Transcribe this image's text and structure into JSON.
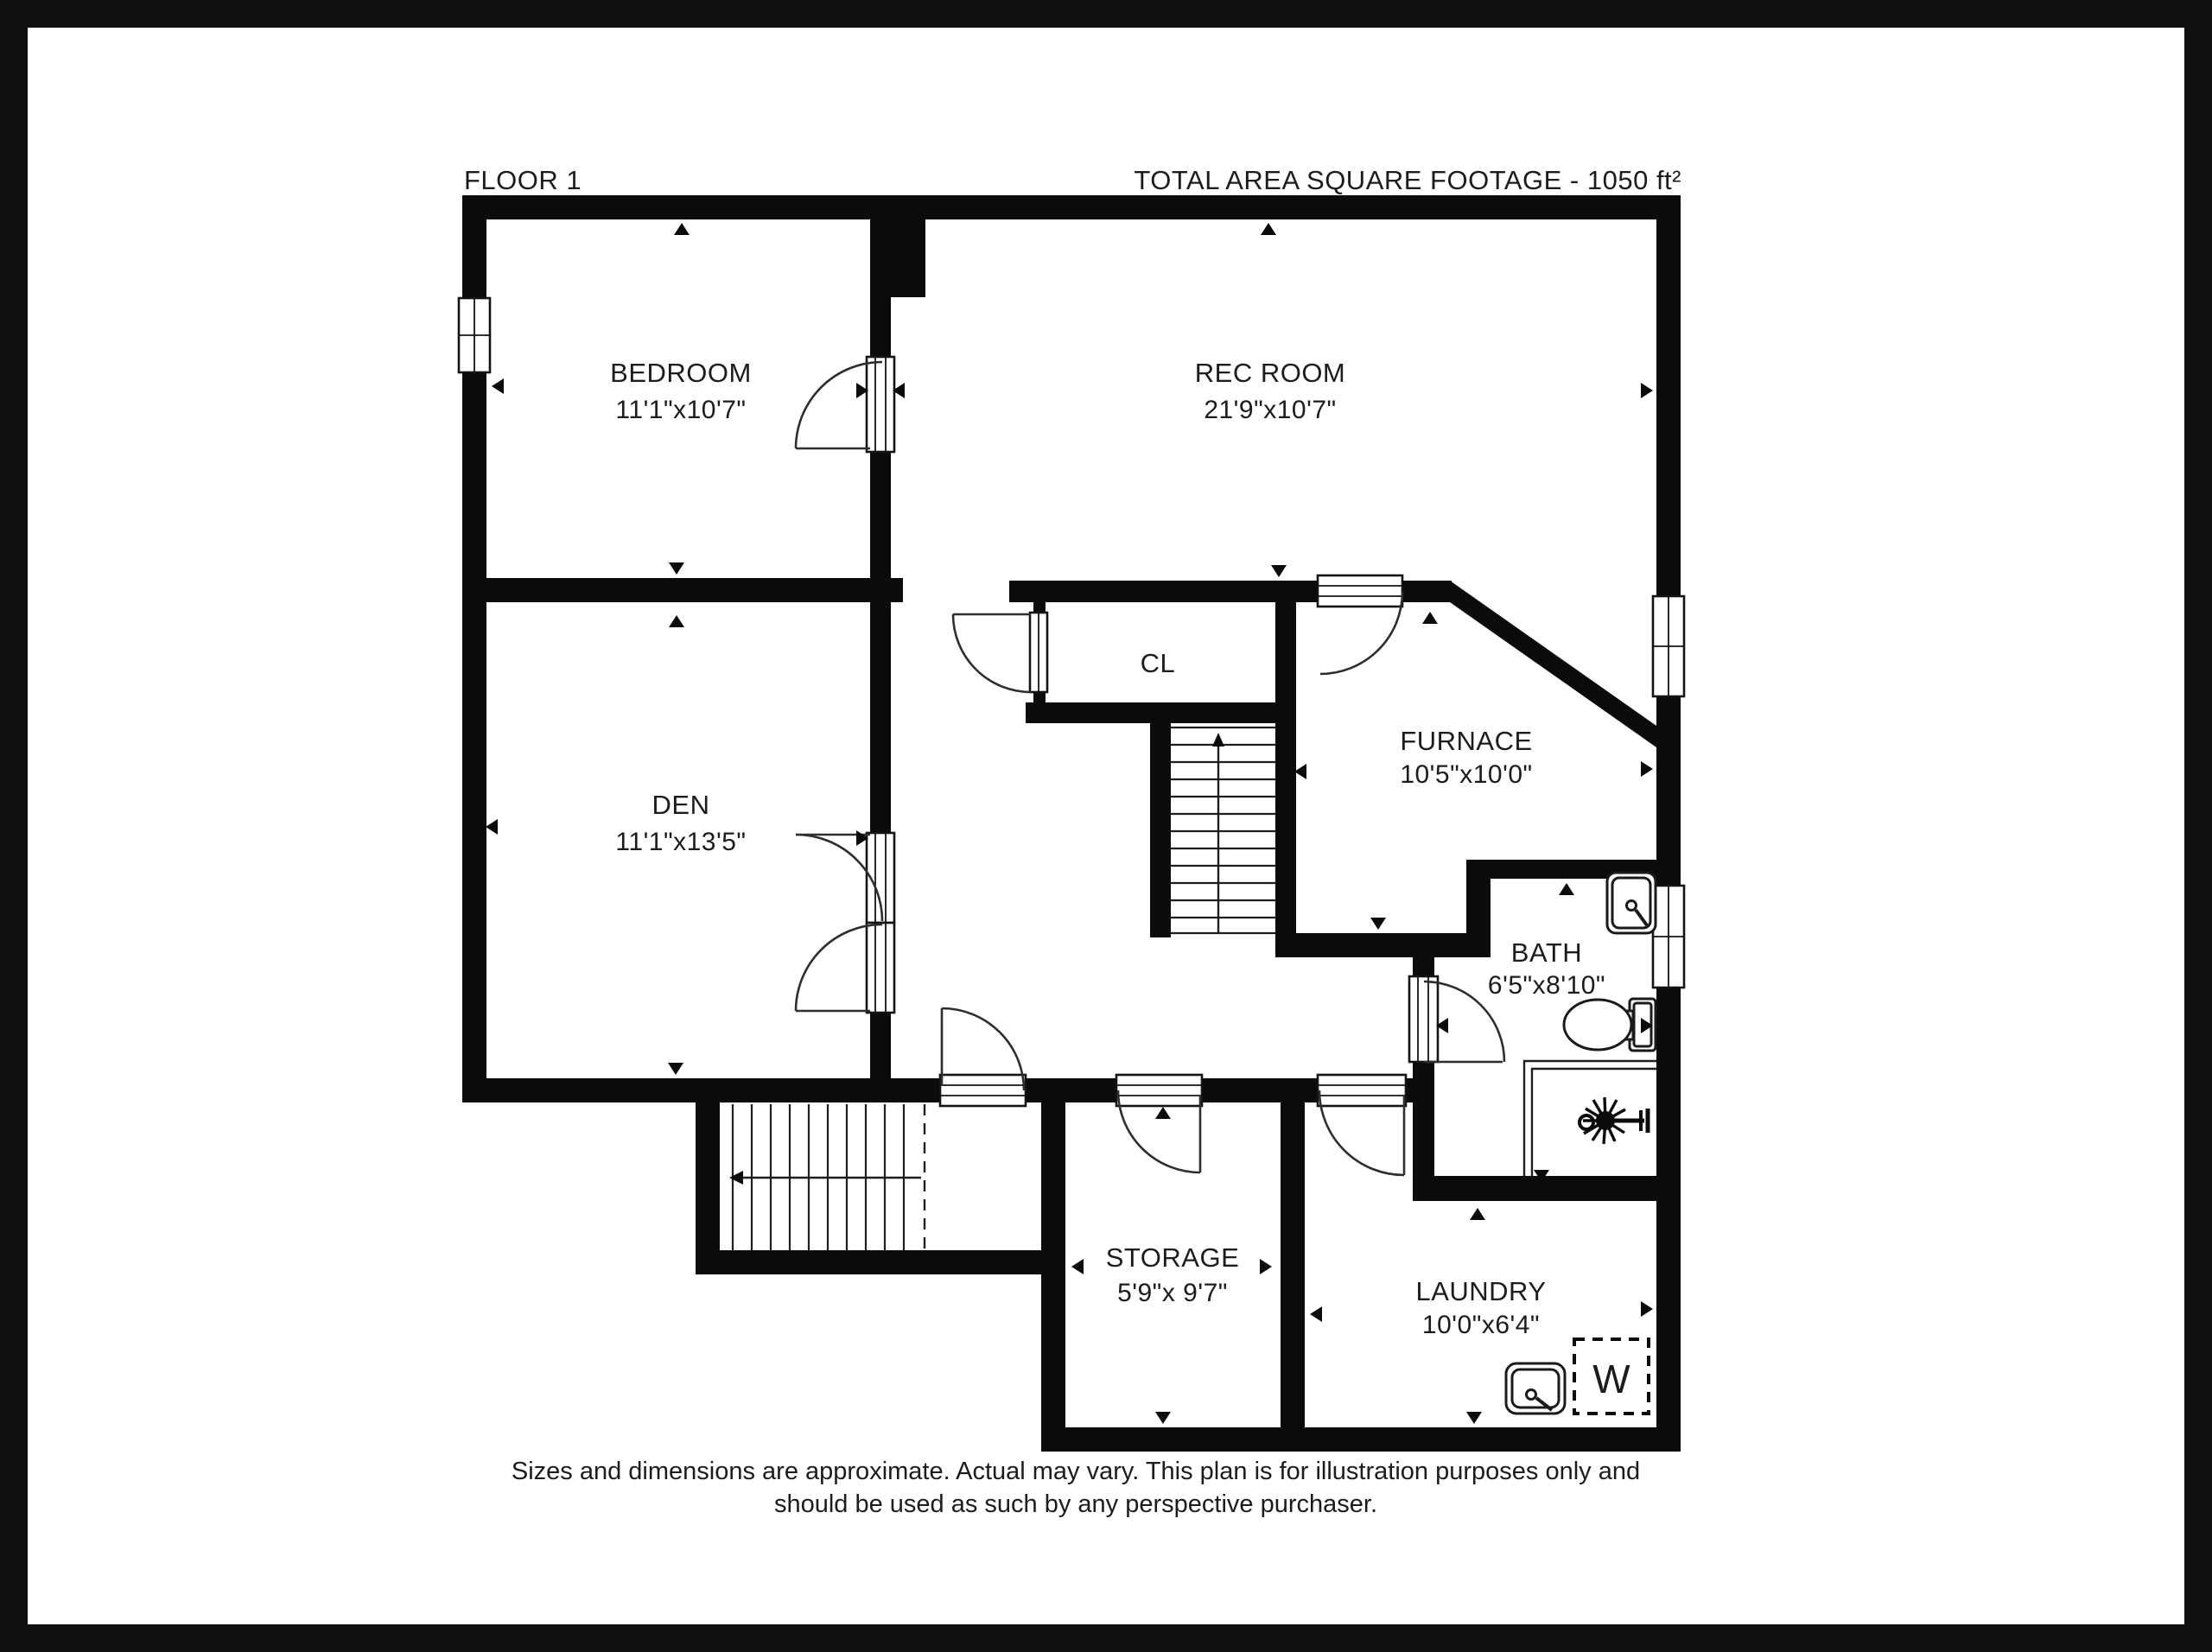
{
  "header": {
    "floor_label": "FLOOR 1",
    "area_label": "TOTAL AREA SQUARE FOOTAGE - 1050 ft²"
  },
  "rooms": {
    "bedroom": {
      "name": "BEDROOM",
      "dims": "11'1\"x10'7\""
    },
    "rec_room": {
      "name": "REC ROOM",
      "dims": "21'9\"x10'7\""
    },
    "den": {
      "name": "DEN",
      "dims": "11'1\"x13'5\""
    },
    "closet": {
      "name": "CL"
    },
    "furnace": {
      "name": "FURNACE",
      "dims": "10'5\"x10'0\""
    },
    "bath": {
      "name": "BATH",
      "dims": "6'5\"x8'10\""
    },
    "storage": {
      "name": "STORAGE",
      "dims": "5'9\"x 9'7\""
    },
    "laundry": {
      "name": "LAUNDRY",
      "dims": "10'0\"x6'4\""
    }
  },
  "fixtures": {
    "washer_label": "W"
  },
  "disclaimer": {
    "line1": "Sizes and dimensions are approximate. Actual may vary. This plan is for illustration purposes only and",
    "line2": "should be used as such by any perspective purchaser."
  },
  "colors": {
    "wall": "#0b0b0b",
    "frame": "#101010",
    "page": "#ffffff",
    "text": "#1c1c1c"
  }
}
